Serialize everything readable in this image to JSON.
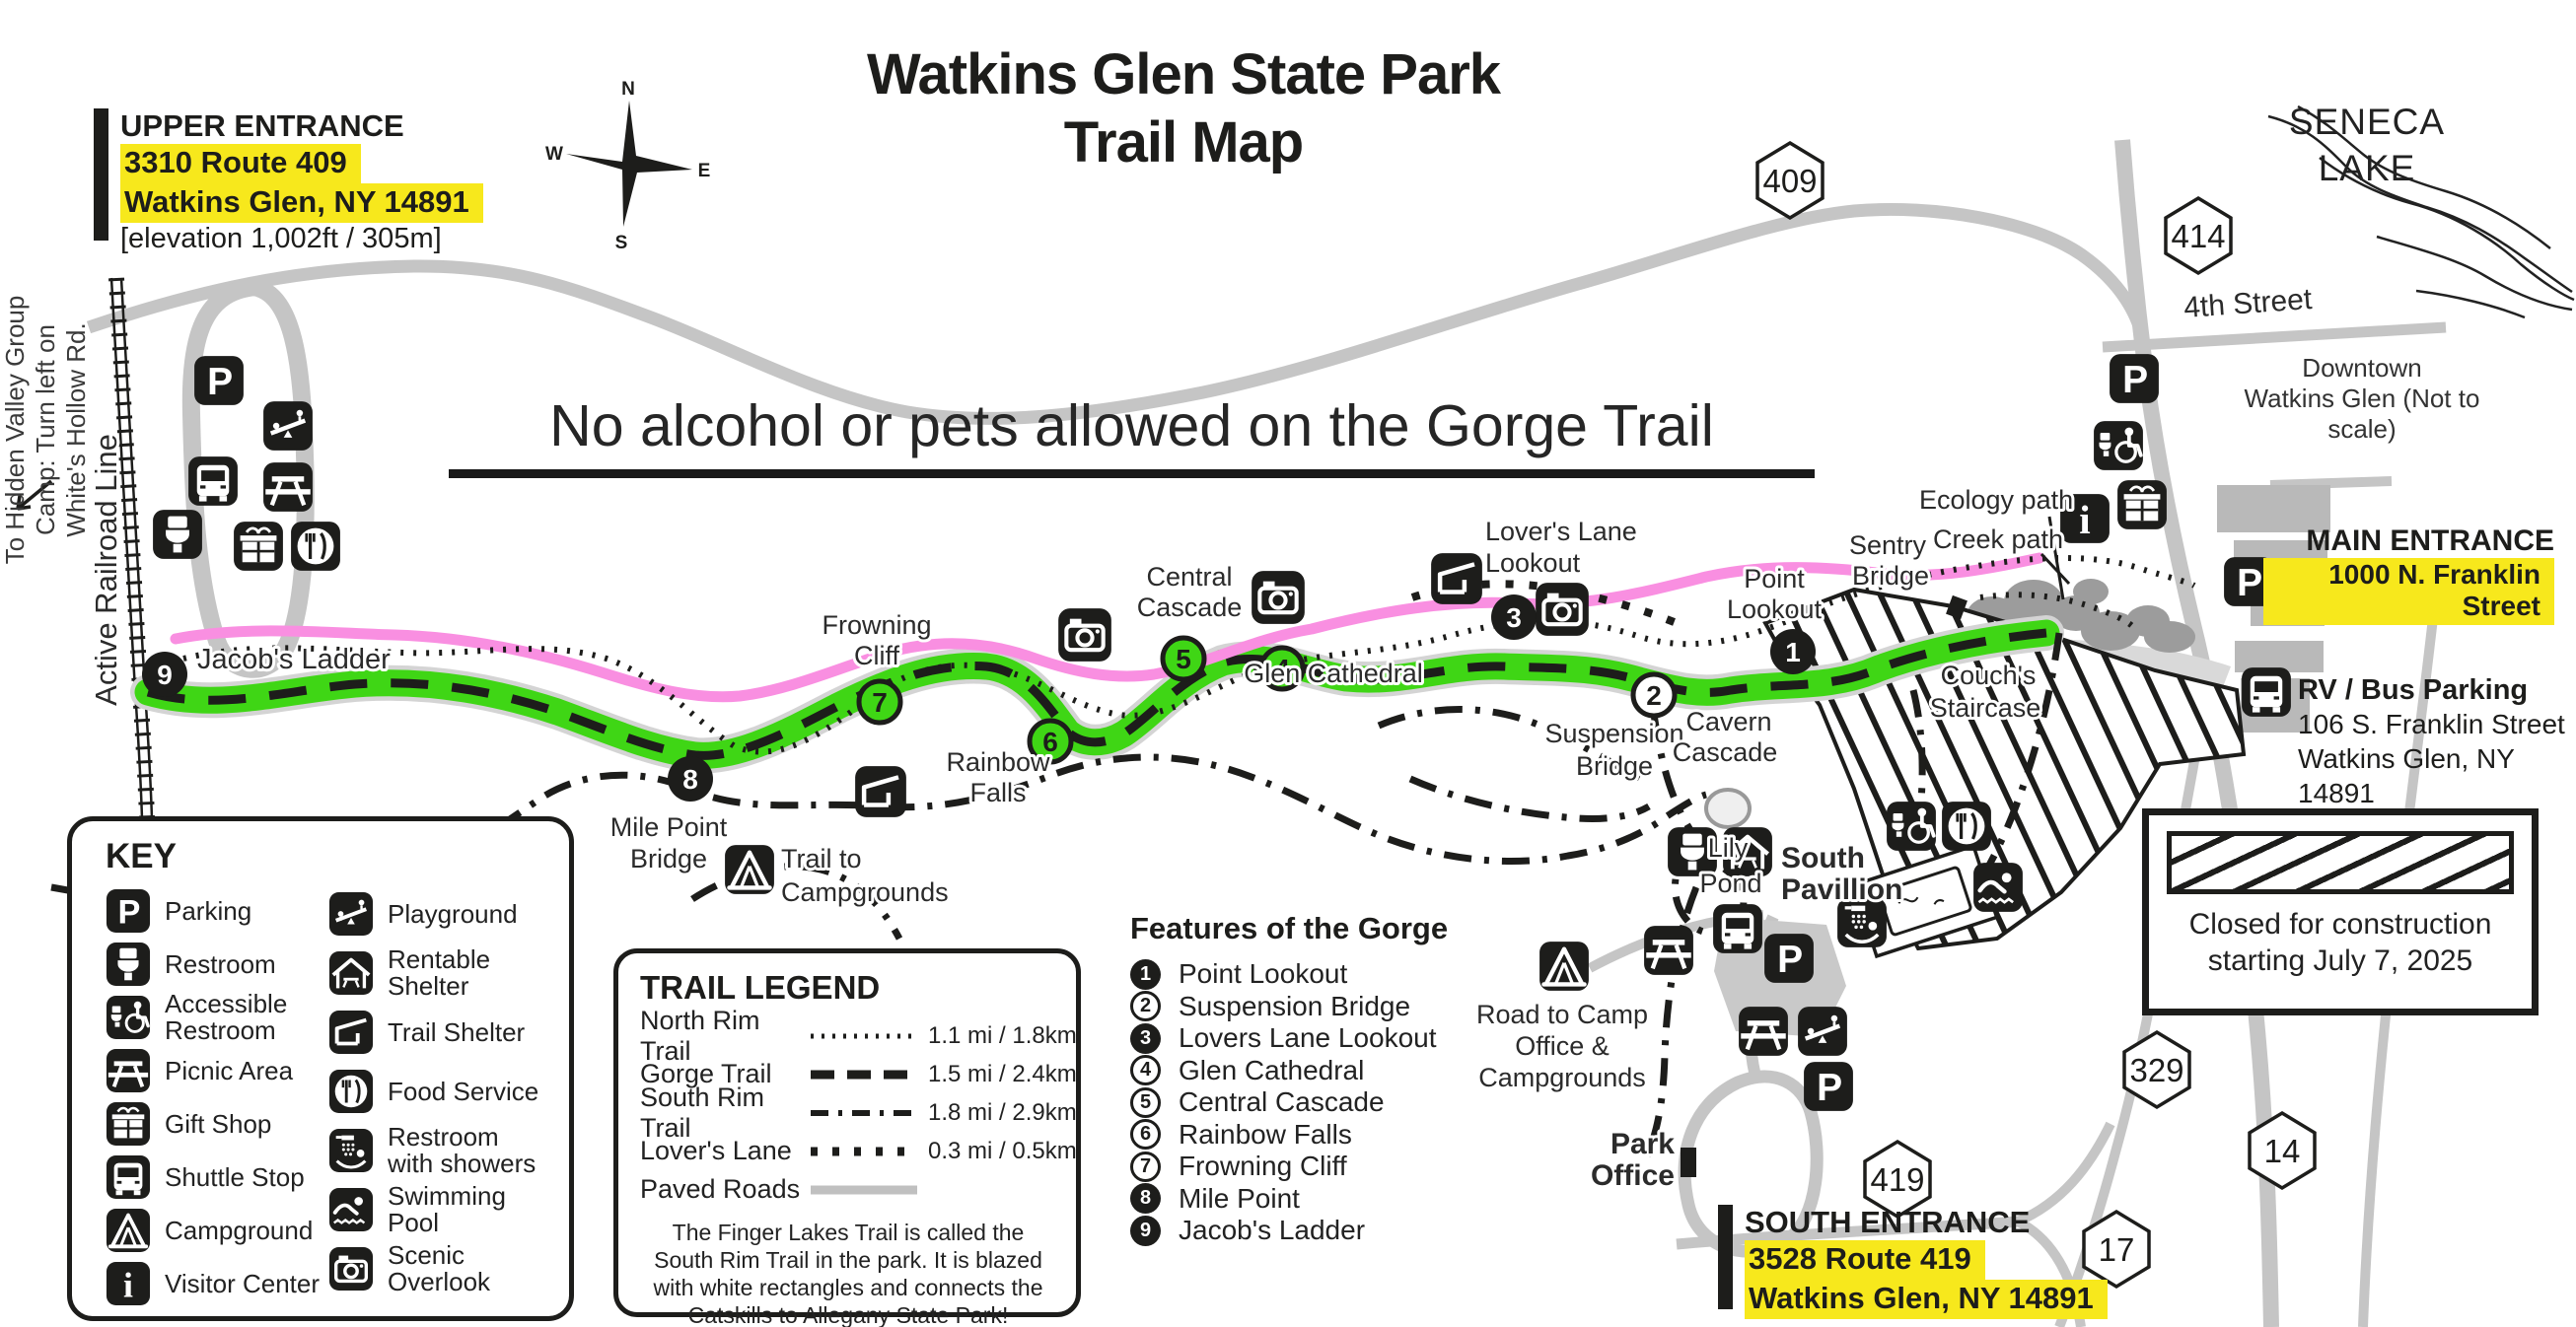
{
  "title": {
    "line1": "Watkins Glen State Park",
    "line2": "Trail Map"
  },
  "banner": {
    "text": "No alcohol or pets allowed on the Gorge Trail"
  },
  "compass": {
    "n": "N",
    "e": "E",
    "s": "S",
    "w": "W"
  },
  "entrances": {
    "upper": {
      "label": "UPPER ENTRANCE",
      "address1": "3310 Route 409",
      "address2": "Watkins Glen, NY 14891",
      "elevation": "[elevation 1,002ft / 305m]"
    },
    "main": {
      "label": "MAIN ENTRANCE",
      "address1": "1000 N. Franklin Street"
    },
    "south": {
      "label": "SOUTH ENTRANCE",
      "address1": "3528 Route 419",
      "address2": "Watkins Glen, NY 14891"
    },
    "rv": {
      "label": "RV / Bus Parking",
      "address1": "106 S. Franklin Street",
      "address2": "Watkins Glen, NY 14891",
      "elevation": "[elevation 479ft /146m]"
    }
  },
  "downtown": {
    "line1": "Downtown",
    "line2": "Watkins Glen  (Not to scale)"
  },
  "seneca": {
    "line1": "SENECA",
    "line2": "LAKE"
  },
  "shields": [
    "409",
    "414",
    "329",
    "17",
    "14",
    "419"
  ],
  "key": {
    "title": "KEY",
    "left": [
      {
        "icon": "parking-icon",
        "label": "Parking"
      },
      {
        "icon": "restroom-icon",
        "label": "Restroom"
      },
      {
        "icon": "accessible-restroom-icon",
        "label": "Accessible Restroom"
      },
      {
        "icon": "picnic-icon",
        "label": "Picnic Area"
      },
      {
        "icon": "gift-shop-icon",
        "label": "Gift Shop"
      },
      {
        "icon": "shuttle-icon",
        "label": "Shuttle Stop"
      },
      {
        "icon": "campground-icon",
        "label": "Campground"
      },
      {
        "icon": "visitor-center-icon",
        "label": "Visitor Center"
      }
    ],
    "right": [
      {
        "icon": "playground-icon",
        "label": "Playground"
      },
      {
        "icon": "rentable-shelter-icon",
        "label": "Rentable Shelter"
      },
      {
        "icon": "trail-shelter-icon",
        "label": "Trail Shelter"
      },
      {
        "icon": "food-service-icon",
        "label": "Food Service"
      },
      {
        "icon": "shower-icon",
        "label": "Restroom with showers"
      },
      {
        "icon": "swimming-icon",
        "label": "Swimming Pool"
      },
      {
        "icon": "scenic-overlook-icon",
        "label": "Scenic Overlook"
      }
    ]
  },
  "trail_legend": {
    "title": "TRAIL LEGEND",
    "rows": [
      {
        "name": "North Rim Trail",
        "distance": "1.1 mi / 1.8km"
      },
      {
        "name": "Gorge Trail",
        "distance": "1.5 mi / 2.4km"
      },
      {
        "name": "South Rim Trail",
        "distance": "1.8 mi / 2.9km"
      },
      {
        "name": "Lover's Lane",
        "distance": "0.3 mi / 0.5km"
      },
      {
        "name": "Paved Roads",
        "distance": ""
      }
    ],
    "note": "The Finger Lakes Trail is called the South Rim Trail in the park. It is blazed with white rectangles and connects the Catskills to Allegany State Park!"
  },
  "features": {
    "title": "Features of the Gorge",
    "items": [
      {
        "num": "1",
        "label": "Point Lookout",
        "filled": true
      },
      {
        "num": "2",
        "label": "Suspension Bridge",
        "filled": false
      },
      {
        "num": "3",
        "label": "Lovers Lane Lookout",
        "filled": true
      },
      {
        "num": "4",
        "label": "Glen Cathedral",
        "filled": false
      },
      {
        "num": "5",
        "label": "Central Cascade",
        "filled": false
      },
      {
        "num": "6",
        "label": "Rainbow Falls",
        "filled": false
      },
      {
        "num": "7",
        "label": "Frowning Cliff",
        "filled": false
      },
      {
        "num": "8",
        "label": "Mile Point",
        "filled": true
      },
      {
        "num": "9",
        "label": "Jacob's Ladder",
        "filled": true
      }
    ]
  },
  "closed_box": {
    "line1": "Closed for construction",
    "line2": "starting July 7, 2025"
  },
  "map_labels": {
    "jacobs_ladder": "Jacob's  Ladder",
    "mile_point": [
      "Mile Point",
      "Bridge"
    ],
    "trail_to_campgrounds": [
      "Trail to",
      "Campgrounds"
    ],
    "frowning_cliff": [
      "Frowning",
      "Cliff"
    ],
    "rainbow_falls": [
      "Rainbow",
      "Falls"
    ],
    "central_cascade": [
      "Central",
      "Cascade"
    ],
    "glen_cathedral": "Glen Cathedral",
    "lovers_lane": [
      "Lover's Lane",
      "Lookout"
    ],
    "suspension_bridge": [
      "Suspension",
      "Bridge"
    ],
    "cavern_cascade": [
      "Cavern",
      "Cascade"
    ],
    "lily_pond": [
      "Lily",
      "Pond"
    ],
    "point_lookout": [
      "Point",
      "Lookout"
    ],
    "sentry_bridge": [
      "Sentry",
      "Bridge"
    ],
    "ecology_path": "Ecology path",
    "creek_path": "Creek path",
    "couchs_staircase": [
      "Couch's",
      "Staircase"
    ],
    "south_pavillion": [
      "South",
      "Pavillion"
    ],
    "road_to_camp": [
      "Road to Camp",
      "Office &",
      "Campgrounds"
    ],
    "park_office": [
      "Park",
      "Office"
    ],
    "active_railroad": "Active Railroad Line",
    "fourth_street": "4th Street",
    "hidden_valley": [
      "To Hidden Valley Group",
      "Camp: Turn left on",
      "White's Hollow Rd."
    ]
  },
  "colors": {
    "highlight_yellow": "#f7e81c",
    "gorge_green": "#3fd615",
    "trail_pink": "#f98fe1",
    "road_gray": "#c5c5c5",
    "ink": "#1d1d1b"
  }
}
